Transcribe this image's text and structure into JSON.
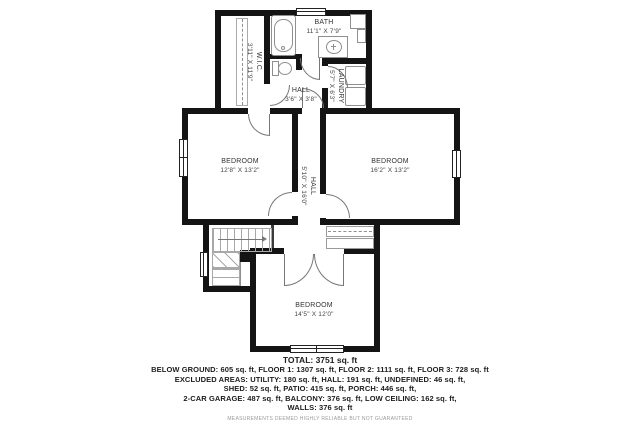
{
  "plan": {
    "rooms": {
      "bath": {
        "name": "BATH",
        "dims": "11'1\" X 7'9\""
      },
      "wic": {
        "name": "W.I.C.",
        "dims": "3'11\" X 11'9\""
      },
      "laundry": {
        "name": "LAUNDRY",
        "dims": "5'7\" X 6'3\""
      },
      "hall_upper": {
        "name": "HALL",
        "dims": "3'6\" X 3'8\""
      },
      "bedroom_left": {
        "name": "BEDROOM",
        "dims": "12'8\" X 13'2\""
      },
      "bedroom_right": {
        "name": "BEDROOM",
        "dims": "16'2\" X 13'2\""
      },
      "hall_main": {
        "name": "HALL",
        "dims": "5'10\" X 16'0\""
      },
      "bedroom_bottom": {
        "name": "BEDROOM",
        "dims": "14'5\" X 12'0\""
      }
    },
    "summary": {
      "total": "TOTAL: 3751 sq. ft",
      "line1": "BELOW GROUND: 605 sq. ft, FLOOR 1: 1307 sq. ft, FLOOR 2: 1111 sq. ft, FLOOR 3: 728 sq. ft",
      "line2": "EXCLUDED AREAS: UTILITY: 180 sq. ft, HALL: 191 sq. ft, UNDEFINED: 46 sq. ft,",
      "line3": "SHED: 52 sq. ft, PATIO: 415 sq. ft, PORCH: 446 sq. ft,",
      "line4": "2-CAR GARAGE: 487 sq. ft, BALCONY: 376 sq. ft, LOW CEILING: 162 sq. ft,",
      "line5": "WALLS: 376 sq. ft",
      "disclaimer": "MEASUREMENTS DEEMED HIGHLY RELIABLE BUT NOT GUARANTEED"
    },
    "colors": {
      "wall": "#141414",
      "fixture": "#8f8f8f",
      "text": "#1d1d1d"
    }
  }
}
